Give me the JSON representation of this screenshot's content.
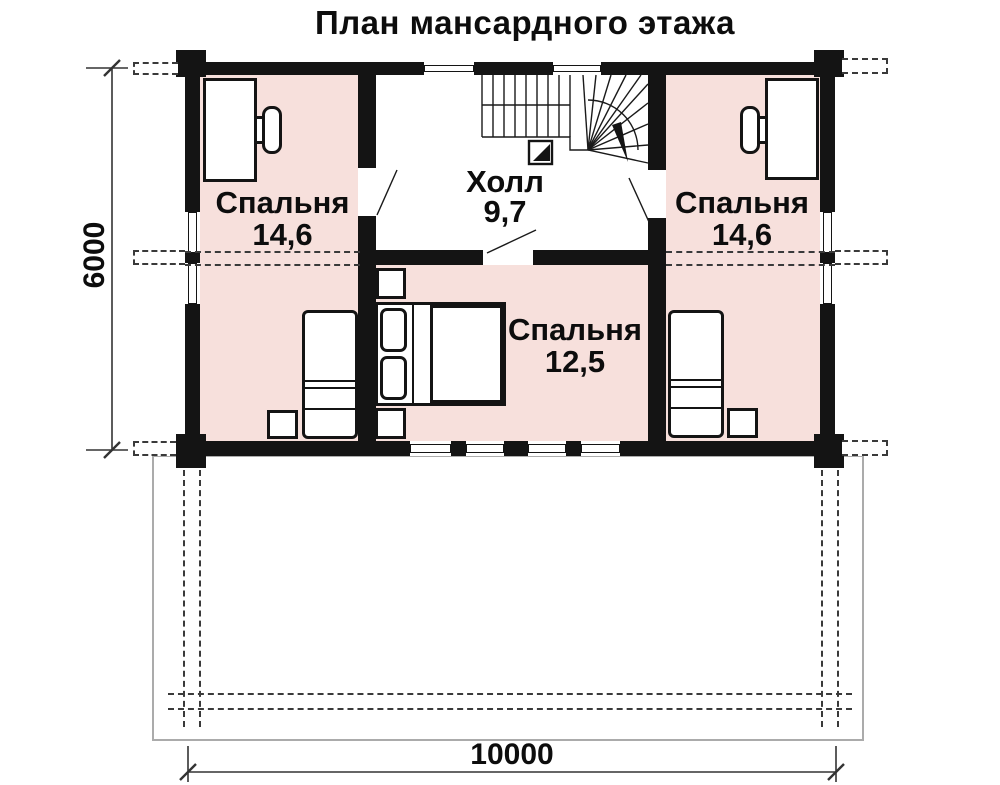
{
  "title": "План мансардного этажа",
  "rooms": {
    "bedroom_left": {
      "name": "Спальня",
      "area": "14,6"
    },
    "hall": {
      "name": "Холл",
      "area": "9,7"
    },
    "bedroom_right": {
      "name": "Спальня",
      "area": "14,6"
    },
    "bedroom_center": {
      "name": "Спальня",
      "area": "12,5"
    }
  },
  "dimensions": {
    "vertical": "6000",
    "horizontal": "10000"
  },
  "colors": {
    "room_fill": "#f7e0dc",
    "wall": "#141414",
    "terrace_line": "#ababab",
    "dash_line": "#3a3a3a"
  }
}
